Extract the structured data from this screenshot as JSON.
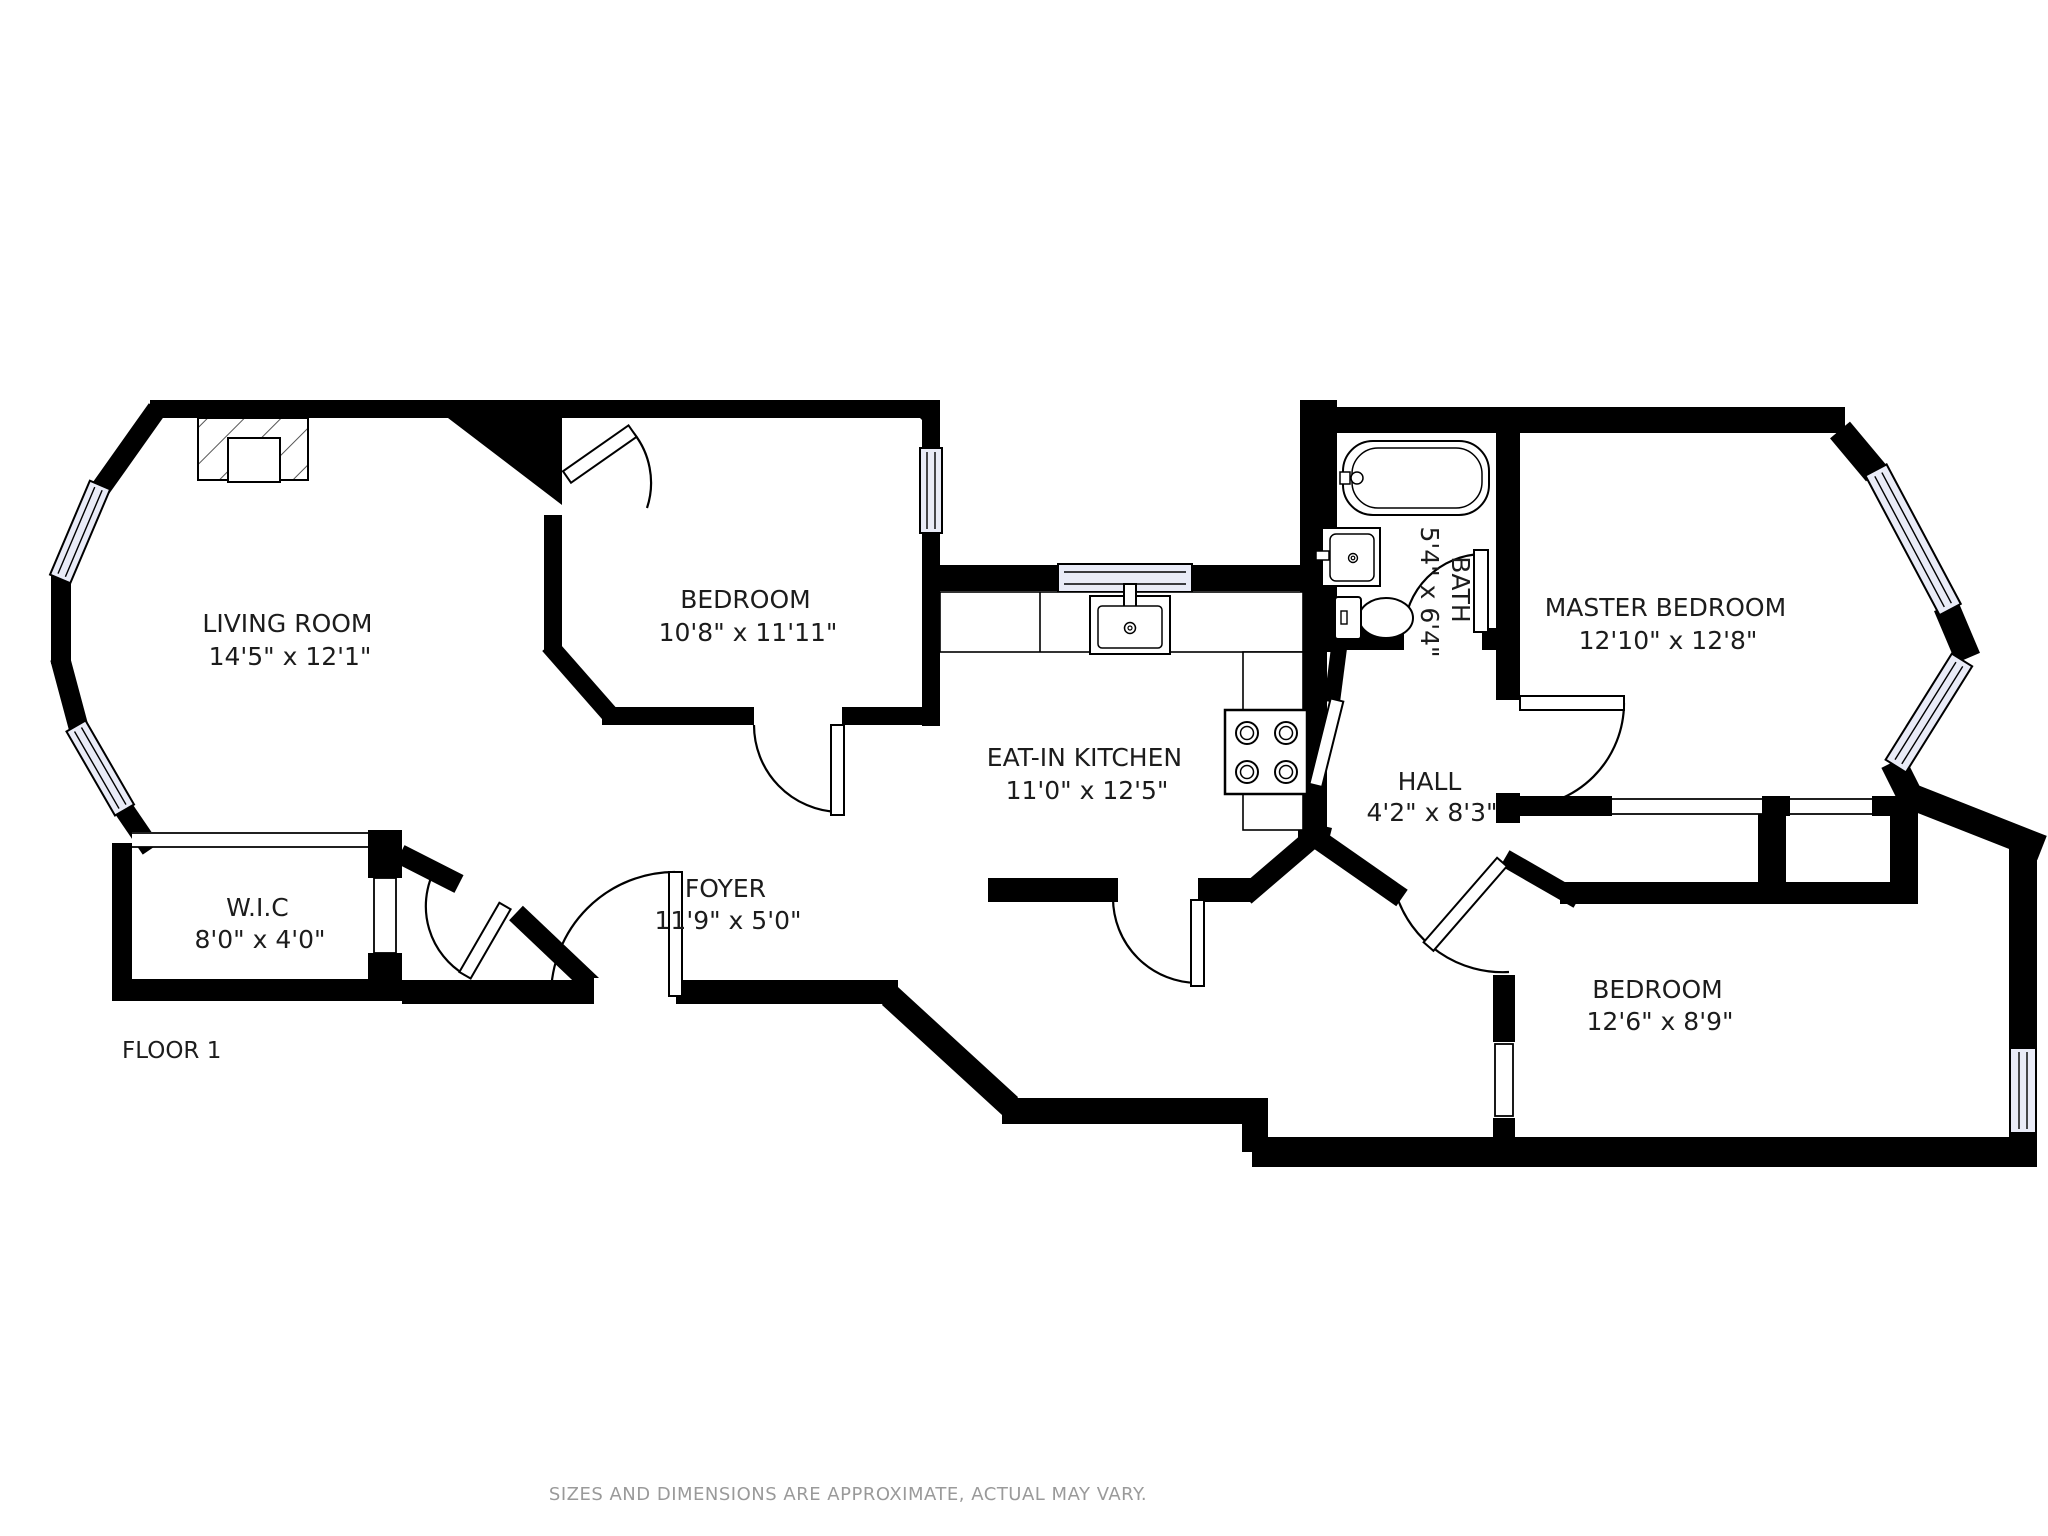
{
  "floor_label": "FLOOR 1",
  "footer": {
    "disclaimer": "SIZES AND DIMENSIONS ARE APPROXIMATE, ACTUAL MAY VARY."
  },
  "rooms": {
    "living_room": {
      "name": "LIVING ROOM",
      "dims": "14'5\" x 12'1\""
    },
    "bedroom1": {
      "name": "BEDROOM",
      "dims": "10'8\" x 11'11\""
    },
    "kitchen": {
      "name": "EAT-IN KITCHEN",
      "dims": "11'0\" x 12'5\""
    },
    "bath": {
      "name": "BATH",
      "dims": "5'4\" x 6'4\""
    },
    "master": {
      "name": "MASTER BEDROOM",
      "dims": "12'10\" x 12'8\""
    },
    "hall": {
      "name": "HALL",
      "dims": "4'2\" x 8'3\""
    },
    "wic": {
      "name": "W.I.C",
      "dims": "8'0\" x 4'0\""
    },
    "foyer": {
      "name": "FOYER",
      "dims": "11'9\" x 5'0\""
    },
    "bedroom2": {
      "name": "BEDROOM",
      "dims": "12'6\" x 8'9\""
    }
  },
  "fixtures": [
    "fireplace",
    "bathtub",
    "bathroom-sink",
    "toilet",
    "kitchen-sink",
    "kitchen-counter",
    "stove",
    "closet",
    "window",
    "door"
  ],
  "colors": {
    "wall": "#000000",
    "window_fill": "#e9ebf7",
    "background": "#ffffff",
    "text": "#1c1c1c",
    "footer_text": "#9a9a9a"
  }
}
